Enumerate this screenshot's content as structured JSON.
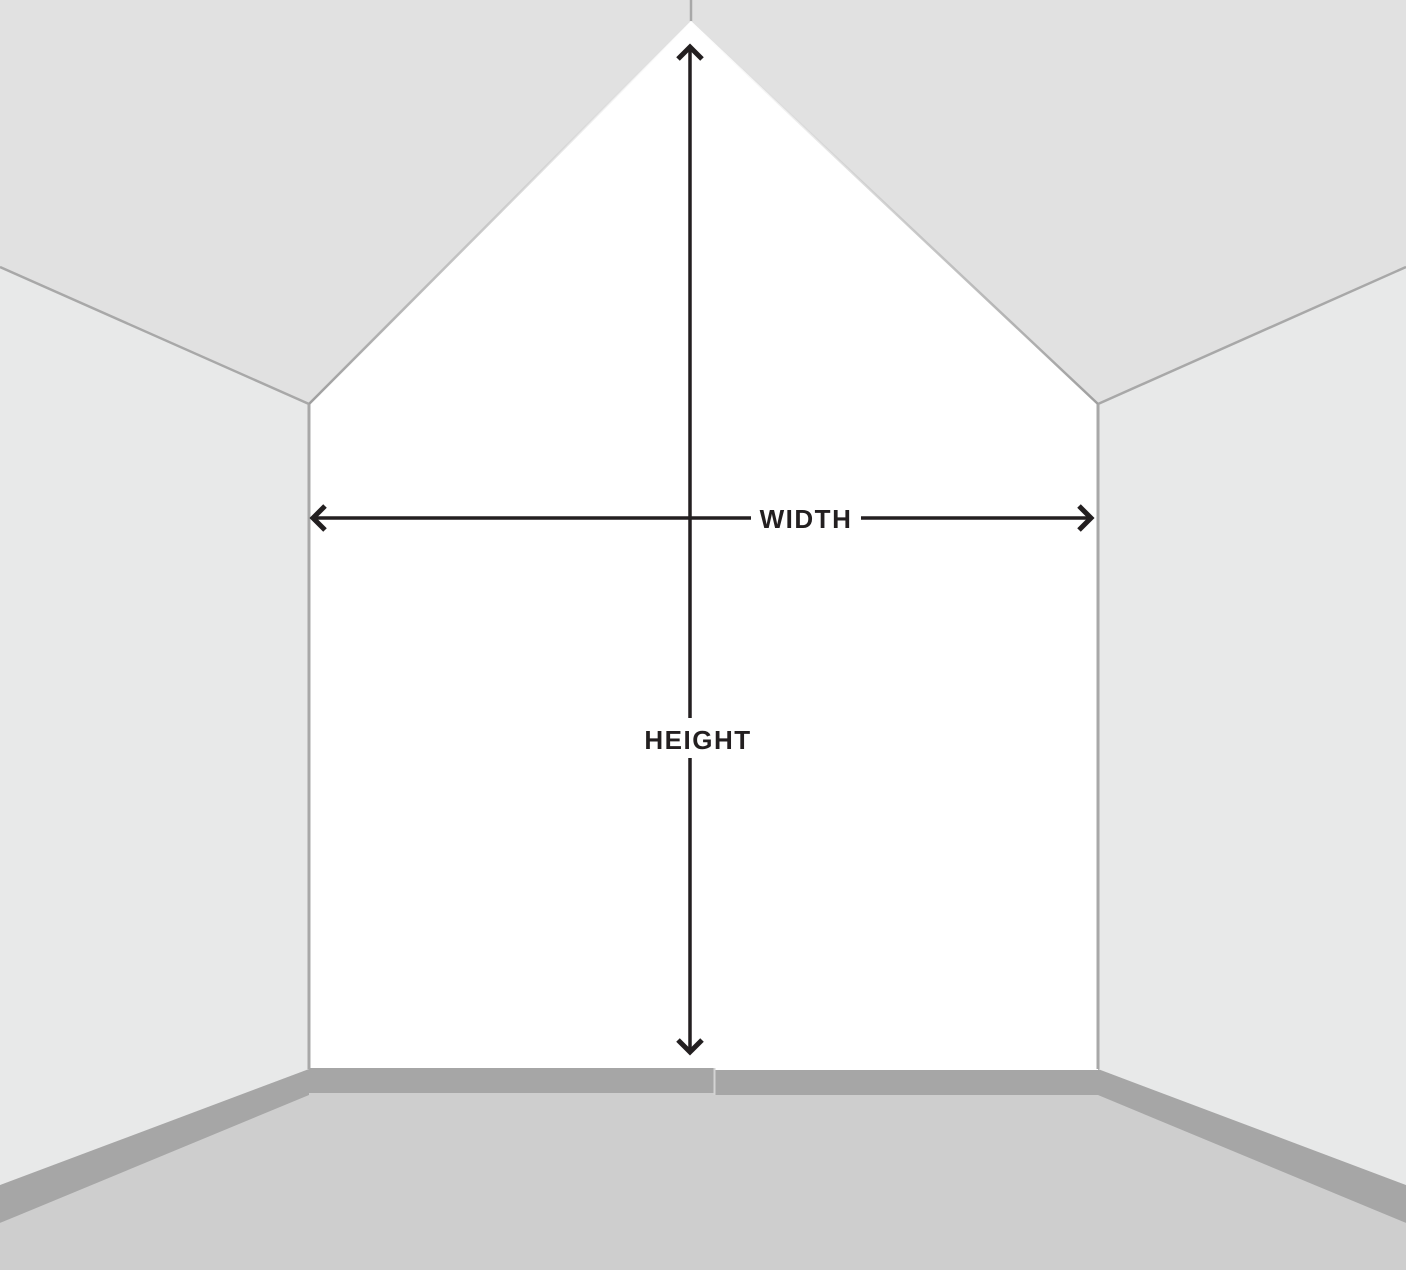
{
  "labels": {
    "width": "WIDTH",
    "height": "HEIGHT"
  },
  "colors": {
    "ceiling": "#e1e1e1",
    "side_wall": "#e8e9e9",
    "feature_wall": "#ffffff",
    "floor": "#cecece",
    "baseboard": "#a6a6a6",
    "baseboard_seam": "#d4d4d4",
    "edge_line": "#a8a8a8",
    "arrow": "#231f20"
  }
}
